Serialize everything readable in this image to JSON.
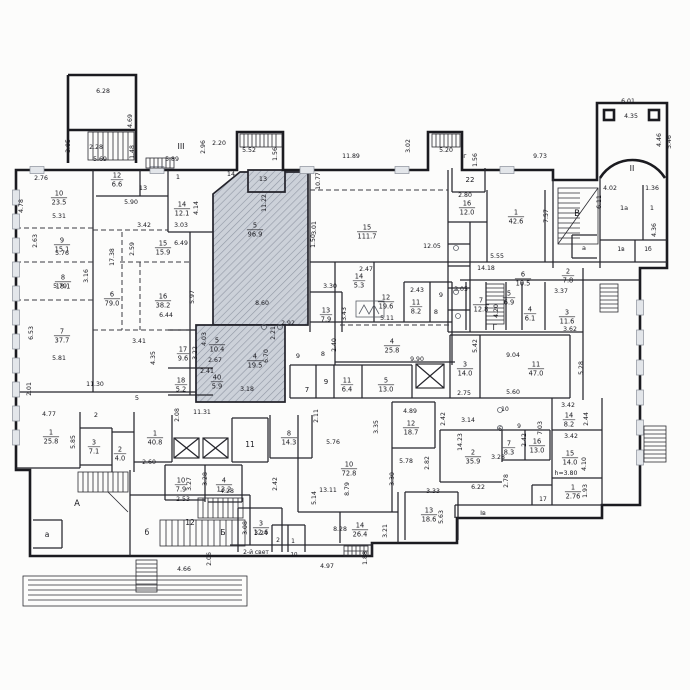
{
  "plan": {
    "kind": "floor-plan",
    "colors": {
      "wall": "#1b1b20",
      "hatch_bg": "#ccd1d9",
      "hatch_line": "#9097a4",
      "text": "#17171d",
      "paper": "#fcfcfb"
    }
  },
  "rooms": [
    {
      "n": "10",
      "a": "23.5",
      "x": 59,
      "y": 197
    },
    {
      "n": "9",
      "a": "15.1",
      "x": 62,
      "y": 244
    },
    {
      "n": "8",
      "a": "18.1",
      "x": 63,
      "y": 281
    },
    {
      "n": "7",
      "a": "37.7",
      "x": 62,
      "y": 335
    },
    {
      "n": "12",
      "a": "6.6",
      "x": 117,
      "y": 179
    },
    {
      "n": "14",
      "a": "12.1",
      "x": 182,
      "y": 208
    },
    {
      "n": "15",
      "a": "15.9",
      "x": 163,
      "y": 247
    },
    {
      "n": "6",
      "a": "79.0",
      "x": 112,
      "y": 298
    },
    {
      "n": "16",
      "a": "38.2",
      "x": 163,
      "y": 300
    },
    {
      "n": "17",
      "a": "9.6",
      "x": 183,
      "y": 353
    },
    {
      "n": "18",
      "a": "5.2",
      "x": 181,
      "y": 384
    },
    {
      "n": "5",
      "a": "10.4",
      "x": 217,
      "y": 344
    },
    {
      "n": "40",
      "a": "5.9",
      "x": 217,
      "y": 381
    },
    {
      "n": "5",
      "a": "96.9",
      "x": 255,
      "y": 229
    },
    {
      "n": "4",
      "a": "19.5",
      "x": 255,
      "y": 360
    },
    {
      "n": "13",
      "a": "7.9",
      "x": 326,
      "y": 314
    },
    {
      "n": "14",
      "a": "5.3",
      "x": 359,
      "y": 280
    },
    {
      "n": "12",
      "a": "19.6",
      "x": 386,
      "y": 301
    },
    {
      "n": "11",
      "a": "8.2",
      "x": 416,
      "y": 306
    },
    {
      "n": "15",
      "a": "111.7",
      "x": 367,
      "y": 231
    },
    {
      "n": "16",
      "a": "12.0",
      "x": 467,
      "y": 207
    },
    {
      "n": "1",
      "a": "42.6",
      "x": 516,
      "y": 216
    },
    {
      "n": "4",
      "a": "25.8",
      "x": 392,
      "y": 345
    },
    {
      "n": "11",
      "a": "6.4",
      "x": 347,
      "y": 384
    },
    {
      "n": "5",
      "a": "13.0",
      "x": 386,
      "y": 384
    },
    {
      "n": "6",
      "a": "10.5",
      "x": 523,
      "y": 278
    },
    {
      "n": "5",
      "a": "6.9",
      "x": 509,
      "y": 297
    },
    {
      "n": "4",
      "a": "6.1",
      "x": 530,
      "y": 313
    },
    {
      "n": "7",
      "a": "12.8",
      "x": 481,
      "y": 304
    },
    {
      "n": "2",
      "a": "7.8",
      "x": 568,
      "y": 275
    },
    {
      "n": "3",
      "a": "11.6",
      "x": 567,
      "y": 316
    },
    {
      "n": "3",
      "a": "14.0",
      "x": 465,
      "y": 368
    },
    {
      "n": "11",
      "a": "47.0",
      "x": 536,
      "y": 368
    },
    {
      "n": "14",
      "a": "8.2",
      "x": 569,
      "y": 419
    },
    {
      "n": "15",
      "a": "14.0",
      "x": 570,
      "y": 457
    },
    {
      "n": "1",
      "a": "2.76",
      "x": 573,
      "y": 491
    },
    {
      "n": "2",
      "a": "35.9",
      "x": 473,
      "y": 456
    },
    {
      "n": "7",
      "a": "8.3",
      "x": 509,
      "y": 447
    },
    {
      "n": "16",
      "a": "13.0",
      "x": 537,
      "y": 445
    },
    {
      "n": "1",
      "a": "40.8",
      "x": 155,
      "y": 437
    },
    {
      "n": "10",
      "a": "7.9",
      "x": 181,
      "y": 484
    },
    {
      "n": "4",
      "a": "13.2",
      "x": 224,
      "y": 484
    },
    {
      "n": "8",
      "a": "14.3",
      "x": 289,
      "y": 437
    },
    {
      "n": "12",
      "a": "18.7",
      "x": 411,
      "y": 427
    },
    {
      "n": "10",
      "a": "72.8",
      "x": 349,
      "y": 468
    },
    {
      "n": "3",
      "a": "12.6",
      "x": 261,
      "y": 527
    },
    {
      "n": "13",
      "a": "18.6",
      "x": 429,
      "y": 514
    },
    {
      "n": "14",
      "a": "26.4",
      "x": 360,
      "y": 529
    },
    {
      "n": "1",
      "a": "25.8",
      "x": 51,
      "y": 436
    },
    {
      "n": "3",
      "a": "7.1",
      "x": 94,
      "y": 446
    },
    {
      "n": "2",
      "a": "4.0",
      "x": 120,
      "y": 453
    }
  ],
  "marks": [
    {
      "t": "III",
      "x": 181,
      "y": 149,
      "fs": 8
    },
    {
      "t": "II",
      "x": 632,
      "y": 171,
      "fs": 8
    },
    {
      "t": "Iг",
      "x": 464,
      "y": 158,
      "fs": 6.5
    },
    {
      "t": "Iв",
      "x": 483,
      "y": 515,
      "fs": 6.5
    },
    {
      "t": "А",
      "x": 77,
      "y": 506,
      "fs": 8.5
    },
    {
      "t": "а",
      "x": 47,
      "y": 537,
      "fs": 7.5
    },
    {
      "t": "б",
      "x": 147,
      "y": 535,
      "fs": 7.5
    },
    {
      "t": "Б",
      "x": 223,
      "y": 535,
      "fs": 7.5
    },
    {
      "t": "В",
      "x": 577,
      "y": 216,
      "fs": 8.5
    },
    {
      "t": "Г",
      "x": 495,
      "y": 330,
      "fs": 8
    },
    {
      "t": "а",
      "x": 584,
      "y": 250,
      "fs": 6.5
    },
    {
      "t": "1а",
      "x": 624,
      "y": 210,
      "fs": 6.5
    },
    {
      "t": "1",
      "x": 652,
      "y": 210,
      "fs": 6.5
    },
    {
      "t": "1в",
      "x": 621,
      "y": 251,
      "fs": 6
    },
    {
      "t": "1б",
      "x": 648,
      "y": 251,
      "fs": 6
    },
    {
      "t": "22",
      "x": 470,
      "y": 182,
      "fs": 7
    },
    {
      "t": "14",
      "x": 231,
      "y": 176,
      "fs": 6.5
    },
    {
      "t": "13",
      "x": 263,
      "y": 181,
      "fs": 6.5
    },
    {
      "t": "13",
      "x": 143,
      "y": 190,
      "fs": 6.5
    },
    {
      "t": "1",
      "x": 178,
      "y": 179,
      "fs": 6.5
    },
    {
      "t": "12",
      "x": 190,
      "y": 525,
      "fs": 7.5
    },
    {
      "t": "11",
      "x": 250,
      "y": 447,
      "fs": 7.5
    },
    {
      "t": "2",
      "x": 96,
      "y": 417,
      "fs": 6.5
    },
    {
      "t": "5",
      "x": 137,
      "y": 400,
      "fs": 6.5
    },
    {
      "t": "7",
      "x": 307,
      "y": 392,
      "fs": 7
    },
    {
      "t": "9",
      "x": 326,
      "y": 384,
      "fs": 7
    },
    {
      "t": "9",
      "x": 298,
      "y": 358,
      "fs": 6.5
    },
    {
      "t": "8",
      "x": 323,
      "y": 356,
      "fs": 6.5
    },
    {
      "t": "9",
      "x": 441,
      "y": 297,
      "fs": 6.5
    },
    {
      "t": "8",
      "x": 436,
      "y": 314,
      "fs": 6.5
    },
    {
      "t": "10",
      "x": 505,
      "y": 411,
      "fs": 6
    },
    {
      "t": "6",
      "x": 500,
      "y": 431,
      "fs": 6
    },
    {
      "t": "9",
      "x": 519,
      "y": 428,
      "fs": 6
    },
    {
      "t": "17",
      "x": 543,
      "y": 501,
      "fs": 6
    },
    {
      "t": "2",
      "x": 278,
      "y": 542,
      "fs": 6
    },
    {
      "t": "1",
      "x": 293,
      "y": 543,
      "fs": 6
    },
    {
      "t": "10",
      "x": 294,
      "y": 556,
      "fs": 5.5
    },
    {
      "t": "2-й свет",
      "x": 256,
      "y": 554,
      "fs": 6
    }
  ],
  "dims": [
    {
      "t": "6.28",
      "x": 103,
      "y": 93
    },
    {
      "t": "4.69",
      "x": 132,
      "y": 121,
      "v": 1
    },
    {
      "t": "3.05",
      "x": 70,
      "y": 146,
      "v": 1
    },
    {
      "t": "2.28",
      "x": 96,
      "y": 149
    },
    {
      "t": "5.69",
      "x": 100,
      "y": 161
    },
    {
      "t": "1.48",
      "x": 134,
      "y": 152,
      "v": 1
    },
    {
      "t": "5.89",
      "x": 172,
      "y": 161
    },
    {
      "t": "2.96",
      "x": 205,
      "y": 147,
      "v": 1
    },
    {
      "t": "2.20",
      "x": 219,
      "y": 145
    },
    {
      "t": "5.52",
      "x": 249,
      "y": 152
    },
    {
      "t": "1.56",
      "x": 277,
      "y": 154,
      "v": 1
    },
    {
      "t": "11.89",
      "x": 351,
      "y": 158
    },
    {
      "t": "3.02",
      "x": 410,
      "y": 146,
      "v": 1
    },
    {
      "t": "5.20",
      "x": 446,
      "y": 152
    },
    {
      "t": "1.56",
      "x": 477,
      "y": 160,
      "v": 1
    },
    {
      "t": "9.73",
      "x": 540,
      "y": 158
    },
    {
      "t": "6.01",
      "x": 628,
      "y": 103
    },
    {
      "t": "4.35",
      "x": 631,
      "y": 118
    },
    {
      "t": "4.46",
      "x": 661,
      "y": 140,
      "v": 1
    },
    {
      "t": "5.46",
      "x": 671,
      "y": 142,
      "v": 1
    },
    {
      "t": "4.02",
      "x": 610,
      "y": 190
    },
    {
      "t": "1.36",
      "x": 652,
      "y": 190
    },
    {
      "t": "4.36",
      "x": 656,
      "y": 230,
      "v": 1
    },
    {
      "t": "6.11",
      "x": 601,
      "y": 202,
      "v": 1
    },
    {
      "t": "7.57",
      "x": 548,
      "y": 216,
      "v": 1
    },
    {
      "t": "2.80",
      "x": 465,
      "y": 197
    },
    {
      "t": "10.77",
      "x": 320,
      "y": 181,
      "v": 1
    },
    {
      "t": "11.22",
      "x": 266,
      "y": 203,
      "v": 1
    },
    {
      "t": "3.01",
      "x": 316,
      "y": 228,
      "v": 1
    },
    {
      "t": "1.50",
      "x": 315,
      "y": 241,
      "v": 1
    },
    {
      "t": "12.05",
      "x": 432,
      "y": 248
    },
    {
      "t": "2.47",
      "x": 366,
      "y": 271
    },
    {
      "t": "3.30",
      "x": 330,
      "y": 288
    },
    {
      "t": "3.43",
      "x": 346,
      "y": 314,
      "v": 1
    },
    {
      "t": "5.11",
      "x": 387,
      "y": 320
    },
    {
      "t": "2.43",
      "x": 417,
      "y": 292
    },
    {
      "t": "3.05",
      "x": 461,
      "y": 291
    },
    {
      "t": "2.40",
      "x": 336,
      "y": 345,
      "v": 1
    },
    {
      "t": "9.90",
      "x": 417,
      "y": 361
    },
    {
      "t": "14.18",
      "x": 486,
      "y": 270
    },
    {
      "t": "5.55",
      "x": 497,
      "y": 258
    },
    {
      "t": "5.42",
      "x": 477,
      "y": 346,
      "v": 1
    },
    {
      "t": "9.04",
      "x": 513,
      "y": 357
    },
    {
      "t": "5.28",
      "x": 583,
      "y": 368,
      "v": 1
    },
    {
      "t": "5.60",
      "x": 513,
      "y": 394
    },
    {
      "t": "2.75",
      "x": 464,
      "y": 395
    },
    {
      "t": "3.37",
      "x": 561,
      "y": 293
    },
    {
      "t": "3.62",
      "x": 570,
      "y": 331
    },
    {
      "t": "4.20",
      "x": 498,
      "y": 311,
      "v": 1
    },
    {
      "t": "3.14",
      "x": 468,
      "y": 422
    },
    {
      "t": "14.23",
      "x": 462,
      "y": 442,
      "v": 1
    },
    {
      "t": "2.42",
      "x": 526,
      "y": 440,
      "v": 1
    },
    {
      "t": "2.42",
      "x": 277,
      "y": 484,
      "v": 1
    },
    {
      "t": "2.42",
      "x": 445,
      "y": 419,
      "v": 1
    },
    {
      "t": "7.03",
      "x": 542,
      "y": 428,
      "v": 1
    },
    {
      "t": "3.42",
      "x": 568,
      "y": 407
    },
    {
      "t": "2.44",
      "x": 588,
      "y": 419,
      "v": 1
    },
    {
      "t": "3.42",
      "x": 571,
      "y": 438
    },
    {
      "t": "4.10",
      "x": 586,
      "y": 464,
      "v": 1
    },
    {
      "t": "1.93",
      "x": 587,
      "y": 491,
      "v": 1
    },
    {
      "t": "h=3.80",
      "x": 566,
      "y": 475
    },
    {
      "t": "6.22",
      "x": 478,
      "y": 489
    },
    {
      "t": "2.78",
      "x": 508,
      "y": 481,
      "v": 1
    },
    {
      "t": "3.28",
      "x": 498,
      "y": 459
    },
    {
      "t": "13.11",
      "x": 328,
      "y": 492
    },
    {
      "t": "8.79",
      "x": 349,
      "y": 489,
      "v": 1
    },
    {
      "t": "5.76",
      "x": 333,
      "y": 444
    },
    {
      "t": "5.78",
      "x": 406,
      "y": 463
    },
    {
      "t": "2.82",
      "x": 429,
      "y": 463,
      "v": 1
    },
    {
      "t": "3.30",
      "x": 394,
      "y": 479,
      "v": 1
    },
    {
      "t": "3.33",
      "x": 433,
      "y": 493
    },
    {
      "t": "5.63",
      "x": 443,
      "y": 517,
      "v": 1
    },
    {
      "t": "3.21",
      "x": 387,
      "y": 531,
      "v": 1
    },
    {
      "t": "5.14",
      "x": 316,
      "y": 498,
      "v": 1
    },
    {
      "t": "2.11",
      "x": 318,
      "y": 416,
      "v": 1
    },
    {
      "t": "4.89",
      "x": 410,
      "y": 413
    },
    {
      "t": "3.35",
      "x": 378,
      "y": 427,
      "v": 1
    },
    {
      "t": "2.53",
      "x": 183,
      "y": 501
    },
    {
      "t": "3.27",
      "x": 191,
      "y": 484,
      "v": 1
    },
    {
      "t": "3.28",
      "x": 207,
      "y": 479,
      "v": 1
    },
    {
      "t": "4.28",
      "x": 227,
      "y": 493
    },
    {
      "t": "2.60",
      "x": 149,
      "y": 464
    },
    {
      "t": "11.30",
      "x": 95,
      "y": 386
    },
    {
      "t": "2.01",
      "x": 31,
      "y": 389,
      "v": 1
    },
    {
      "t": "4.77",
      "x": 49,
      "y": 416
    },
    {
      "t": "5.85",
      "x": 75,
      "y": 442,
      "v": 1
    },
    {
      "t": "5.81",
      "x": 59,
      "y": 360
    },
    {
      "t": "6.53",
      "x": 33,
      "y": 333,
      "v": 1
    },
    {
      "t": "2.63",
      "x": 37,
      "y": 241,
      "v": 1
    },
    {
      "t": "5.76",
      "x": 62,
      "y": 255
    },
    {
      "t": "3.16",
      "x": 88,
      "y": 276,
      "v": 1
    },
    {
      "t": "5.79",
      "x": 60,
      "y": 288
    },
    {
      "t": "4.78",
      "x": 23,
      "y": 206,
      "v": 1
    },
    {
      "t": "5.31",
      "x": 59,
      "y": 218
    },
    {
      "t": "2.76",
      "x": 41,
      "y": 180
    },
    {
      "t": "17.38",
      "x": 114,
      "y": 257,
      "v": 1
    },
    {
      "t": "2.59",
      "x": 134,
      "y": 249,
      "v": 1
    },
    {
      "t": "5.90",
      "x": 131,
      "y": 204
    },
    {
      "t": "3.42",
      "x": 144,
      "y": 227
    },
    {
      "t": "3.03",
      "x": 181,
      "y": 227
    },
    {
      "t": "6.49",
      "x": 181,
      "y": 245
    },
    {
      "t": "4.14",
      "x": 198,
      "y": 208,
      "v": 1
    },
    {
      "t": "4.03",
      "x": 206,
      "y": 339,
      "v": 1
    },
    {
      "t": "2.67",
      "x": 215,
      "y": 362
    },
    {
      "t": "2.41",
      "x": 207,
      "y": 373
    },
    {
      "t": "3.22",
      "x": 197,
      "y": 353,
      "v": 1
    },
    {
      "t": "6.70",
      "x": 268,
      "y": 356,
      "v": 1
    },
    {
      "t": "2.92",
      "x": 288,
      "y": 325
    },
    {
      "t": "2.21",
      "x": 275,
      "y": 333,
      "v": 1
    },
    {
      "t": "8.60",
      "x": 262,
      "y": 305
    },
    {
      "t": "5.97",
      "x": 194,
      "y": 297,
      "v": 1
    },
    {
      "t": "6.44",
      "x": 166,
      "y": 317
    },
    {
      "t": "3.41",
      "x": 139,
      "y": 343
    },
    {
      "t": "4.35",
      "x": 155,
      "y": 358,
      "v": 1
    },
    {
      "t": "2.08",
      "x": 179,
      "y": 415,
      "v": 1
    },
    {
      "t": "11.31",
      "x": 202,
      "y": 414
    },
    {
      "t": "3.18",
      "x": 247,
      "y": 391
    },
    {
      "t": "3.08",
      "x": 247,
      "y": 528,
      "v": 1
    },
    {
      "t": "3.24",
      "x": 261,
      "y": 535
    },
    {
      "t": "8.28",
      "x": 340,
      "y": 531
    },
    {
      "t": "4.66",
      "x": 184,
      "y": 571
    },
    {
      "t": "2.06",
      "x": 211,
      "y": 559,
      "v": 1
    },
    {
      "t": "4.97",
      "x": 327,
      "y": 568
    },
    {
      "t": "1.88",
      "x": 367,
      "y": 558,
      "v": 1
    }
  ]
}
